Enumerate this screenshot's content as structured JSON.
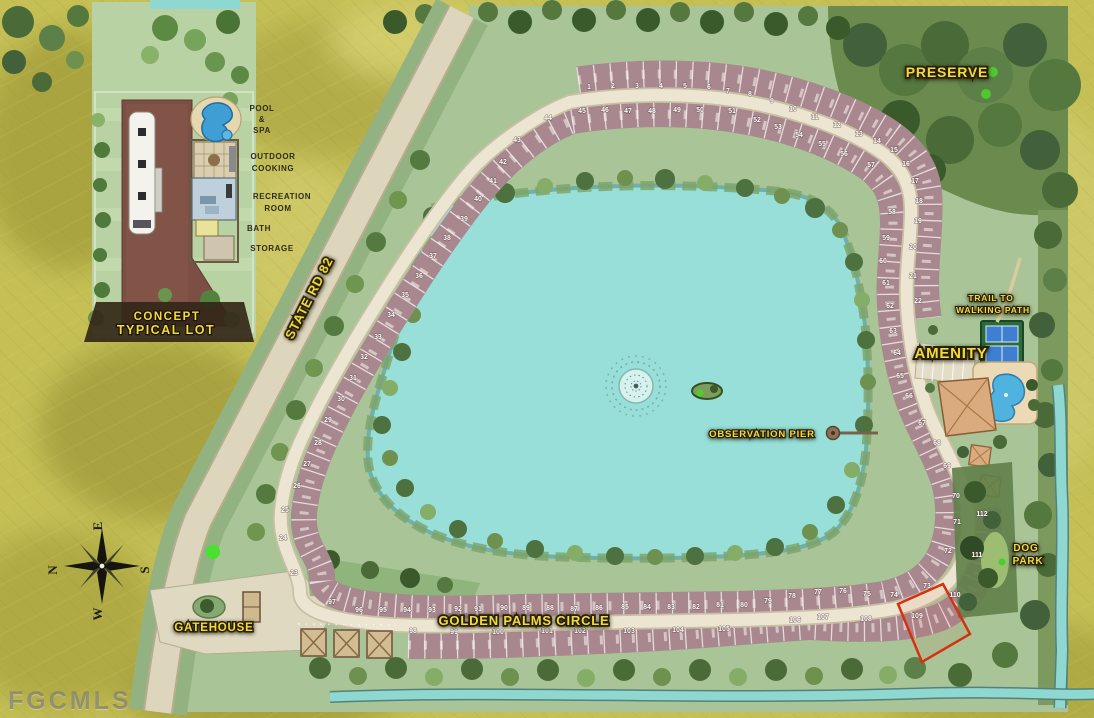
{
  "watermark": "FGCMLS",
  "colors": {
    "background": "#c5bf56",
    "site_green": "#a9c497",
    "lake": "#97dfd8",
    "road": "#ece5d1",
    "lot_band": "#a8888e",
    "label_yellow": "#f4da3e",
    "highlight_red": "#d5310f",
    "preserve_green": "#6b8a4e"
  },
  "inset": {
    "title_line1": "CONCEPT",
    "title_line2": "TYPICAL LOT",
    "labels": [
      {
        "text": "POOL",
        "x": 262,
        "y": 111
      },
      {
        "text": "&",
        "x": 262,
        "y": 122
      },
      {
        "text": "SPA",
        "x": 262,
        "y": 133
      },
      {
        "text": "OUTDOOR",
        "x": 273,
        "y": 159
      },
      {
        "text": "COOKING",
        "x": 273,
        "y": 171
      },
      {
        "text": "RECREATION",
        "x": 282,
        "y": 199
      },
      {
        "text": "ROOM",
        "x": 278,
        "y": 211
      },
      {
        "text": "BATH",
        "x": 259,
        "y": 231
      },
      {
        "text": "STORAGE",
        "x": 272,
        "y": 251
      }
    ]
  },
  "map_labels": [
    {
      "text": "PRESERVE",
      "x": 947,
      "y": 77,
      "size": 14
    },
    {
      "text": "STATE RD 82",
      "x": 313,
      "y": 300,
      "size": 13,
      "rotate": -63
    },
    {
      "text": "TRAIL TO",
      "x": 991,
      "y": 301,
      "size": 8.5
    },
    {
      "text": "WALKING PATH",
      "x": 993,
      "y": 313,
      "size": 8.5
    },
    {
      "text": "AMENITY",
      "x": 951,
      "y": 358,
      "size": 15
    },
    {
      "text": "OBSERVATION PIER",
      "x": 762,
      "y": 437,
      "size": 9.5
    },
    {
      "text": "DOG",
      "x": 1026,
      "y": 551,
      "size": 10
    },
    {
      "text": "PARK",
      "x": 1028,
      "y": 564,
      "size": 10
    },
    {
      "text": "GATEHOUSE",
      "x": 214,
      "y": 631,
      "size": 11.5
    },
    {
      "text": "GOLDEN PALMS CIRCLE",
      "x": 524,
      "y": 625,
      "size": 13
    }
  ],
  "compass": {
    "letters": [
      {
        "text": "E",
        "x": 102,
        "y": 526,
        "rotate": -90
      },
      {
        "text": "N",
        "x": 57,
        "y": 570,
        "rotate": -90
      },
      {
        "text": "S",
        "x": 149,
        "y": 570,
        "rotate": -90
      },
      {
        "text": "W",
        "x": 102,
        "y": 614,
        "rotate": -90
      }
    ]
  },
  "highlighted_lot": 109,
  "lots": [
    {
      "n": 1,
      "x": 589,
      "y": 89
    },
    {
      "n": 2,
      "x": 613,
      "y": 88
    },
    {
      "n": 3,
      "x": 637,
      "y": 88
    },
    {
      "n": 4,
      "x": 661,
      "y": 88
    },
    {
      "n": 5,
      "x": 685,
      "y": 88
    },
    {
      "n": 6,
      "x": 709,
      "y": 89
    },
    {
      "n": 7,
      "x": 728,
      "y": 93
    },
    {
      "n": 8,
      "x": 750,
      "y": 96
    },
    {
      "n": 9,
      "x": 772,
      "y": 103
    },
    {
      "n": 10,
      "x": 793,
      "y": 111
    },
    {
      "n": 11,
      "x": 815,
      "y": 119
    },
    {
      "n": 12,
      "x": 837,
      "y": 127
    },
    {
      "n": 13,
      "x": 859,
      "y": 136
    },
    {
      "n": 14,
      "x": 877,
      "y": 143
    },
    {
      "n": 15,
      "x": 894,
      "y": 152
    },
    {
      "n": 16,
      "x": 906,
      "y": 166
    },
    {
      "n": 17,
      "x": 915,
      "y": 183
    },
    {
      "n": 18,
      "x": 919,
      "y": 203
    },
    {
      "n": 19,
      "x": 918,
      "y": 223
    },
    {
      "n": 20,
      "x": 913,
      "y": 249
    },
    {
      "n": 21,
      "x": 913,
      "y": 278
    },
    {
      "n": 22,
      "x": 918,
      "y": 303
    },
    {
      "n": 23,
      "x": 294,
      "y": 575
    },
    {
      "n": 24,
      "x": 283,
      "y": 540
    },
    {
      "n": 25,
      "x": 285,
      "y": 512
    },
    {
      "n": 26,
      "x": 297,
      "y": 488
    },
    {
      "n": 27,
      "x": 307,
      "y": 466
    },
    {
      "n": 28,
      "x": 318,
      "y": 445
    },
    {
      "n": 29,
      "x": 328,
      "y": 422
    },
    {
      "n": 30,
      "x": 341,
      "y": 401
    },
    {
      "n": 31,
      "x": 353,
      "y": 380
    },
    {
      "n": 32,
      "x": 364,
      "y": 359
    },
    {
      "n": 33,
      "x": 378,
      "y": 339
    },
    {
      "n": 34,
      "x": 391,
      "y": 317
    },
    {
      "n": 35,
      "x": 405,
      "y": 297
    },
    {
      "n": 36,
      "x": 419,
      "y": 278
    },
    {
      "n": 37,
      "x": 433,
      "y": 258
    },
    {
      "n": 38,
      "x": 447,
      "y": 240
    },
    {
      "n": 39,
      "x": 464,
      "y": 221
    },
    {
      "n": 40,
      "x": 478,
      "y": 201
    },
    {
      "n": 41,
      "x": 493,
      "y": 183
    },
    {
      "n": 42,
      "x": 503,
      "y": 164
    },
    {
      "n": 43,
      "x": 517,
      "y": 142
    },
    {
      "n": 44,
      "x": 548,
      "y": 120
    },
    {
      "n": 45,
      "x": 582,
      "y": 113
    },
    {
      "n": 46,
      "x": 605,
      "y": 112
    },
    {
      "n": 47,
      "x": 628,
      "y": 113
    },
    {
      "n": 48,
      "x": 652,
      "y": 113
    },
    {
      "n": 49,
      "x": 677,
      "y": 112
    },
    {
      "n": 50,
      "x": 700,
      "y": 112
    },
    {
      "n": 51,
      "x": 732,
      "y": 113
    },
    {
      "n": 52,
      "x": 757,
      "y": 122
    },
    {
      "n": 53,
      "x": 778,
      "y": 129
    },
    {
      "n": 54,
      "x": 799,
      "y": 137
    },
    {
      "n": 55,
      "x": 822,
      "y": 146
    },
    {
      "n": 56,
      "x": 844,
      "y": 156
    },
    {
      "n": 57,
      "x": 871,
      "y": 167
    },
    {
      "n": 58,
      "x": 892,
      "y": 214
    },
    {
      "n": 59,
      "x": 886,
      "y": 240
    },
    {
      "n": 60,
      "x": 883,
      "y": 263
    },
    {
      "n": 61,
      "x": 886,
      "y": 285
    },
    {
      "n": 62,
      "x": 890,
      "y": 308
    },
    {
      "n": 63,
      "x": 893,
      "y": 333
    },
    {
      "n": 64,
      "x": 897,
      "y": 355
    },
    {
      "n": 65,
      "x": 900,
      "y": 378
    },
    {
      "n": 66,
      "x": 909,
      "y": 398
    },
    {
      "n": 67,
      "x": 922,
      "y": 425
    },
    {
      "n": 68,
      "x": 937,
      "y": 445
    },
    {
      "n": 69,
      "x": 947,
      "y": 468
    },
    {
      "n": 70,
      "x": 956,
      "y": 498
    },
    {
      "n": 71,
      "x": 957,
      "y": 524
    },
    {
      "n": 72,
      "x": 948,
      "y": 553
    },
    {
      "n": 73,
      "x": 927,
      "y": 588
    },
    {
      "n": 74,
      "x": 894,
      "y": 597
    },
    {
      "n": 75,
      "x": 867,
      "y": 596
    },
    {
      "n": 76,
      "x": 843,
      "y": 593
    },
    {
      "n": 77,
      "x": 818,
      "y": 594
    },
    {
      "n": 78,
      "x": 792,
      "y": 598
    },
    {
      "n": 79,
      "x": 768,
      "y": 603
    },
    {
      "n": 80,
      "x": 744,
      "y": 607
    },
    {
      "n": 81,
      "x": 720,
      "y": 607
    },
    {
      "n": 82,
      "x": 696,
      "y": 609
    },
    {
      "n": 83,
      "x": 671,
      "y": 609
    },
    {
      "n": 84,
      "x": 647,
      "y": 609
    },
    {
      "n": 85,
      "x": 625,
      "y": 609
    },
    {
      "n": 86,
      "x": 599,
      "y": 610
    },
    {
      "n": 87,
      "x": 574,
      "y": 611
    },
    {
      "n": 88,
      "x": 550,
      "y": 610
    },
    {
      "n": 89,
      "x": 526,
      "y": 610
    },
    {
      "n": 90,
      "x": 504,
      "y": 610
    },
    {
      "n": 91,
      "x": 478,
      "y": 611
    },
    {
      "n": 92,
      "x": 458,
      "y": 611
    },
    {
      "n": 93,
      "x": 432,
      "y": 612
    },
    {
      "n": 94,
      "x": 407,
      "y": 612
    },
    {
      "n": 95,
      "x": 383,
      "y": 612
    },
    {
      "n": 96,
      "x": 359,
      "y": 612
    },
    {
      "n": 97,
      "x": 332,
      "y": 604
    },
    {
      "n": 98,
      "x": 413,
      "y": 633
    },
    {
      "n": 99,
      "x": 454,
      "y": 634
    },
    {
      "n": 100,
      "x": 498,
      "y": 634
    },
    {
      "n": 101,
      "x": 547,
      "y": 633
    },
    {
      "n": 102,
      "x": 580,
      "y": 633
    },
    {
      "n": 103,
      "x": 629,
      "y": 633
    },
    {
      "n": 104,
      "x": 678,
      "y": 632
    },
    {
      "n": 105,
      "x": 724,
      "y": 631
    },
    {
      "n": 106,
      "x": 795,
      "y": 622
    },
    {
      "n": 107,
      "x": 823,
      "y": 619
    },
    {
      "n": 108,
      "x": 866,
      "y": 621
    },
    {
      "n": 109,
      "x": 917,
      "y": 618
    },
    {
      "n": 110,
      "x": 955,
      "y": 597
    },
    {
      "n": 111,
      "x": 977,
      "y": 557
    },
    {
      "n": 112,
      "x": 982,
      "y": 516
    }
  ]
}
